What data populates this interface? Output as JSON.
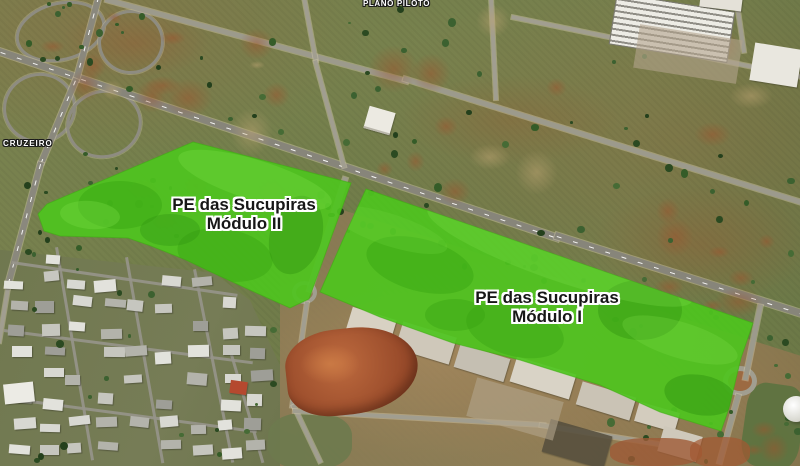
{
  "map": {
    "place_labels": [
      {
        "id": "plano-piloto",
        "text": "PLANO PILOTO"
      },
      {
        "id": "cruzeiro",
        "text": "CRUZEIRO"
      }
    ],
    "overlays": [
      {
        "id": "modulo-2",
        "name_line1": "PE das Sucupiras",
        "name_line2": "Módulo II",
        "fill": "#4ec41e",
        "points": "193,142 351,183 309,299 290,308 252,291 211,272 186,260 151,246 128,238 60,236 44,231 38,214 47,204"
      },
      {
        "id": "modulo-1",
        "name_line1": "PE das Sucupiras",
        "name_line2": "Módulo I",
        "fill": "#4ec41e",
        "points": "366,189 753,323 741,358 729,408 721,431 660,412 600,385 520,360 453,343 380,317 320,292 345,235"
      }
    ],
    "colors": {
      "overlay_fill": "#4ec41e",
      "area_label_text": "#171717",
      "area_label_outline": "#ffffff",
      "place_label_text": "#ffffff",
      "place_label_outline": "#1a1a1a"
    }
  }
}
